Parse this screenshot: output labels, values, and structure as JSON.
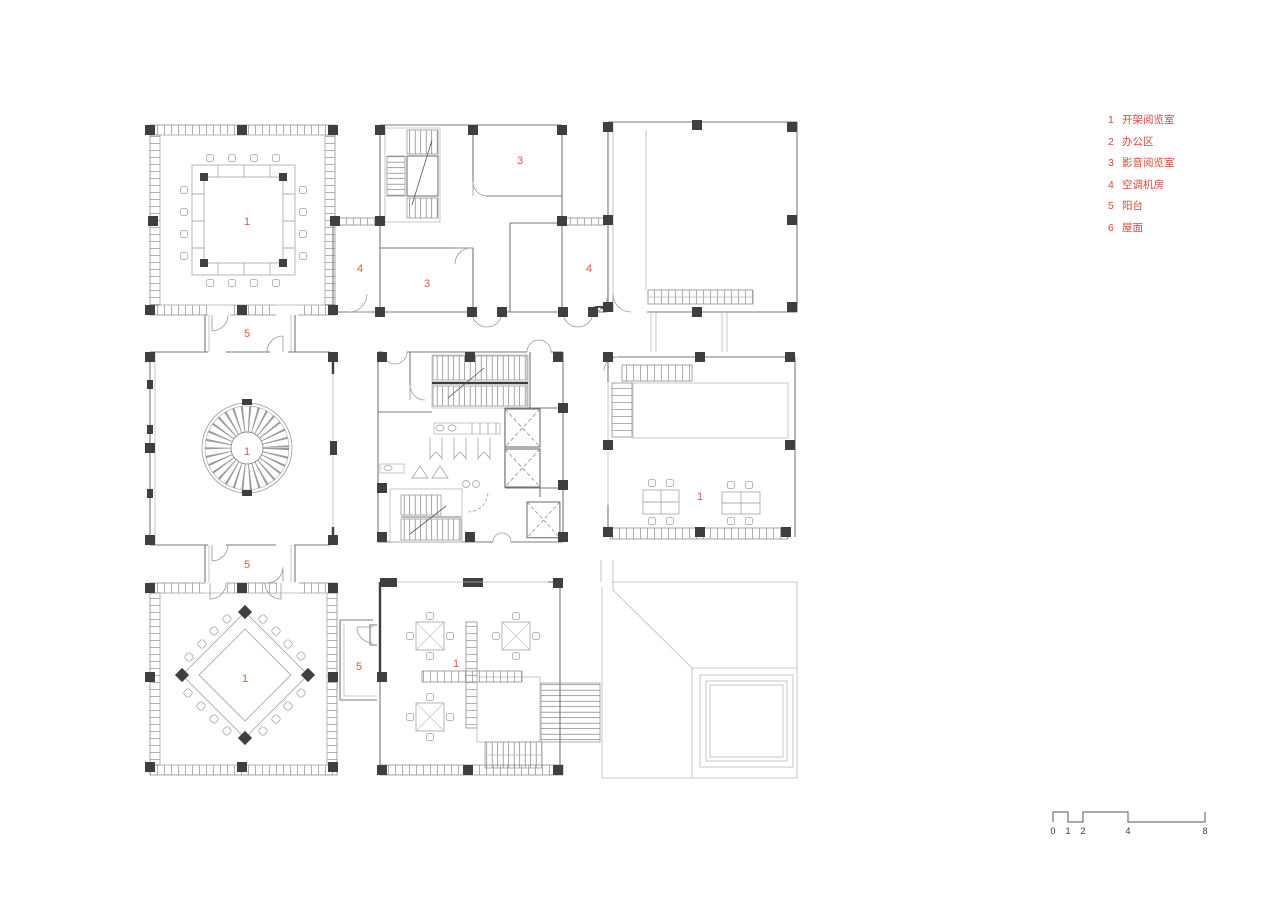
{
  "legend": {
    "items": [
      {
        "num": "1",
        "label": "开架阅览室"
      },
      {
        "num": "2",
        "label": "办公区"
      },
      {
        "num": "3",
        "label": "影音阅览室"
      },
      {
        "num": "4",
        "label": "空调机房"
      },
      {
        "num": "5",
        "label": "阳台"
      },
      {
        "num": "6",
        "label": "屋面"
      }
    ]
  },
  "room_labels": [
    {
      "id": "reading-room-nw",
      "text": "1"
    },
    {
      "id": "av-room-upper",
      "text": "3"
    },
    {
      "id": "ac-plant-left",
      "text": "4"
    },
    {
      "id": "av-room-lower",
      "text": "3"
    },
    {
      "id": "ac-plant-right",
      "text": "4"
    },
    {
      "id": "balcony-upper",
      "text": "5"
    },
    {
      "id": "spiral-reading-room",
      "text": "1"
    },
    {
      "id": "balcony-middle",
      "text": "5"
    },
    {
      "id": "reading-room-east",
      "text": "1"
    },
    {
      "id": "reading-room-sw",
      "text": "1"
    },
    {
      "id": "balcony-lower",
      "text": "5"
    },
    {
      "id": "reading-room-south",
      "text": "1"
    }
  ],
  "scale_bar": {
    "ticks": [
      "0",
      "1",
      "2",
      "4",
      "8"
    ]
  },
  "colors": {
    "legend_red": "#d9473b",
    "plan_label_red": "#de564c",
    "wall_gray": "#787878",
    "column_dark": "#3f3f3f",
    "furniture_gray": "#adadad"
  }
}
